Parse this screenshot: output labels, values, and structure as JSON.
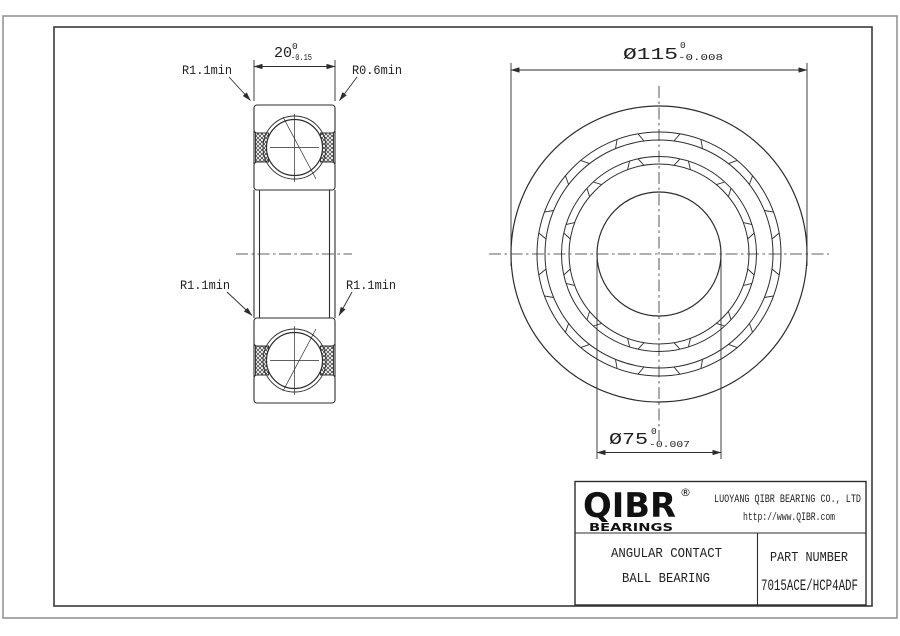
{
  "colors": {
    "background": "#ffffff",
    "line": "#2d2d2d",
    "frame": "#3a3a3a",
    "page_edge": "#949494"
  },
  "dimensions": {
    "width": {
      "value": "20",
      "tol_upper": "0",
      "tol_lower": "-0.15"
    },
    "outer_diameter": {
      "value": "Ø115",
      "tol_upper": "0",
      "tol_lower": "-0.008"
    },
    "bore_diameter": {
      "value": "Ø75",
      "tol_upper": "0",
      "tol_lower": "-0.007"
    }
  },
  "callouts": {
    "top_left_radius": "R1.1min",
    "top_right_radius": "R0.6min",
    "mid_left_radius": "R1.1min",
    "mid_right_radius": "R1.1min"
  },
  "title_block": {
    "logo_text": "QIBR",
    "logo_registered": "®",
    "logo_sub": "BEARINGS",
    "company": "LUOYANG QIBR BEARING CO., LTD",
    "website": "http://www.QIBR.com",
    "product_line1": "ANGULAR CONTACT",
    "product_line2": "BALL BEARING",
    "part_number_label": "PART NUMBER",
    "part_number": "7015ACE/HCP4ADF"
  }
}
